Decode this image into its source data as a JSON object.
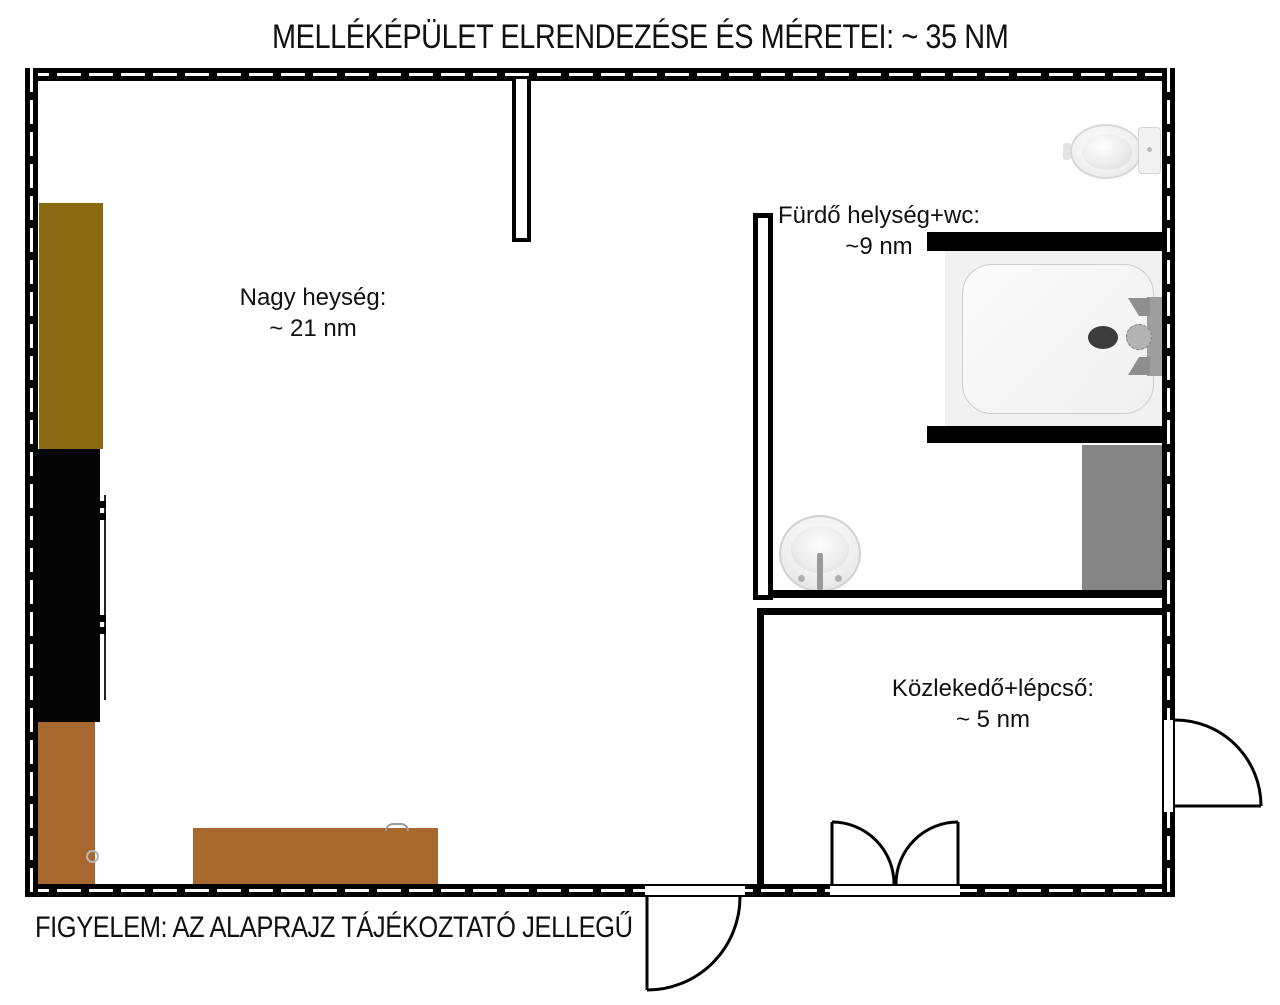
{
  "title": "MELLÉKÉPÜLET ELRENDEZÉSE ÉS MÉRETEI: ~ 35 NM",
  "footer": "FIGYELEM: AZ ALAPRAJZ TÁJÉKOZTATÓ JELLEGŰ",
  "rooms": {
    "large": {
      "label": "Nagy heység:",
      "area": "~ 21 nm"
    },
    "bathroom": {
      "label": "Fürdő helység+wc:",
      "area": "~9 nm"
    },
    "corridor": {
      "label": "Közlekedő+lépcső:",
      "area": "~ 5 nm"
    }
  },
  "fixtures": [
    "toilet-icon",
    "shower-tray-icon",
    "shower-drain-icon",
    "shower-mixer-icon",
    "washbasin-icon",
    "door-swing-icon",
    "double-door-swing-icon"
  ],
  "colors": {
    "wall": "#000000",
    "olive_cabinet": "#8a6a10",
    "black_cabinet": "#050505",
    "brown_furniture": "#a8672f",
    "gray_unit": "#858585",
    "shower_area": "#f1f1f1",
    "fixture_fill": "#f2f2f2",
    "drain": "#3c3c3c"
  }
}
